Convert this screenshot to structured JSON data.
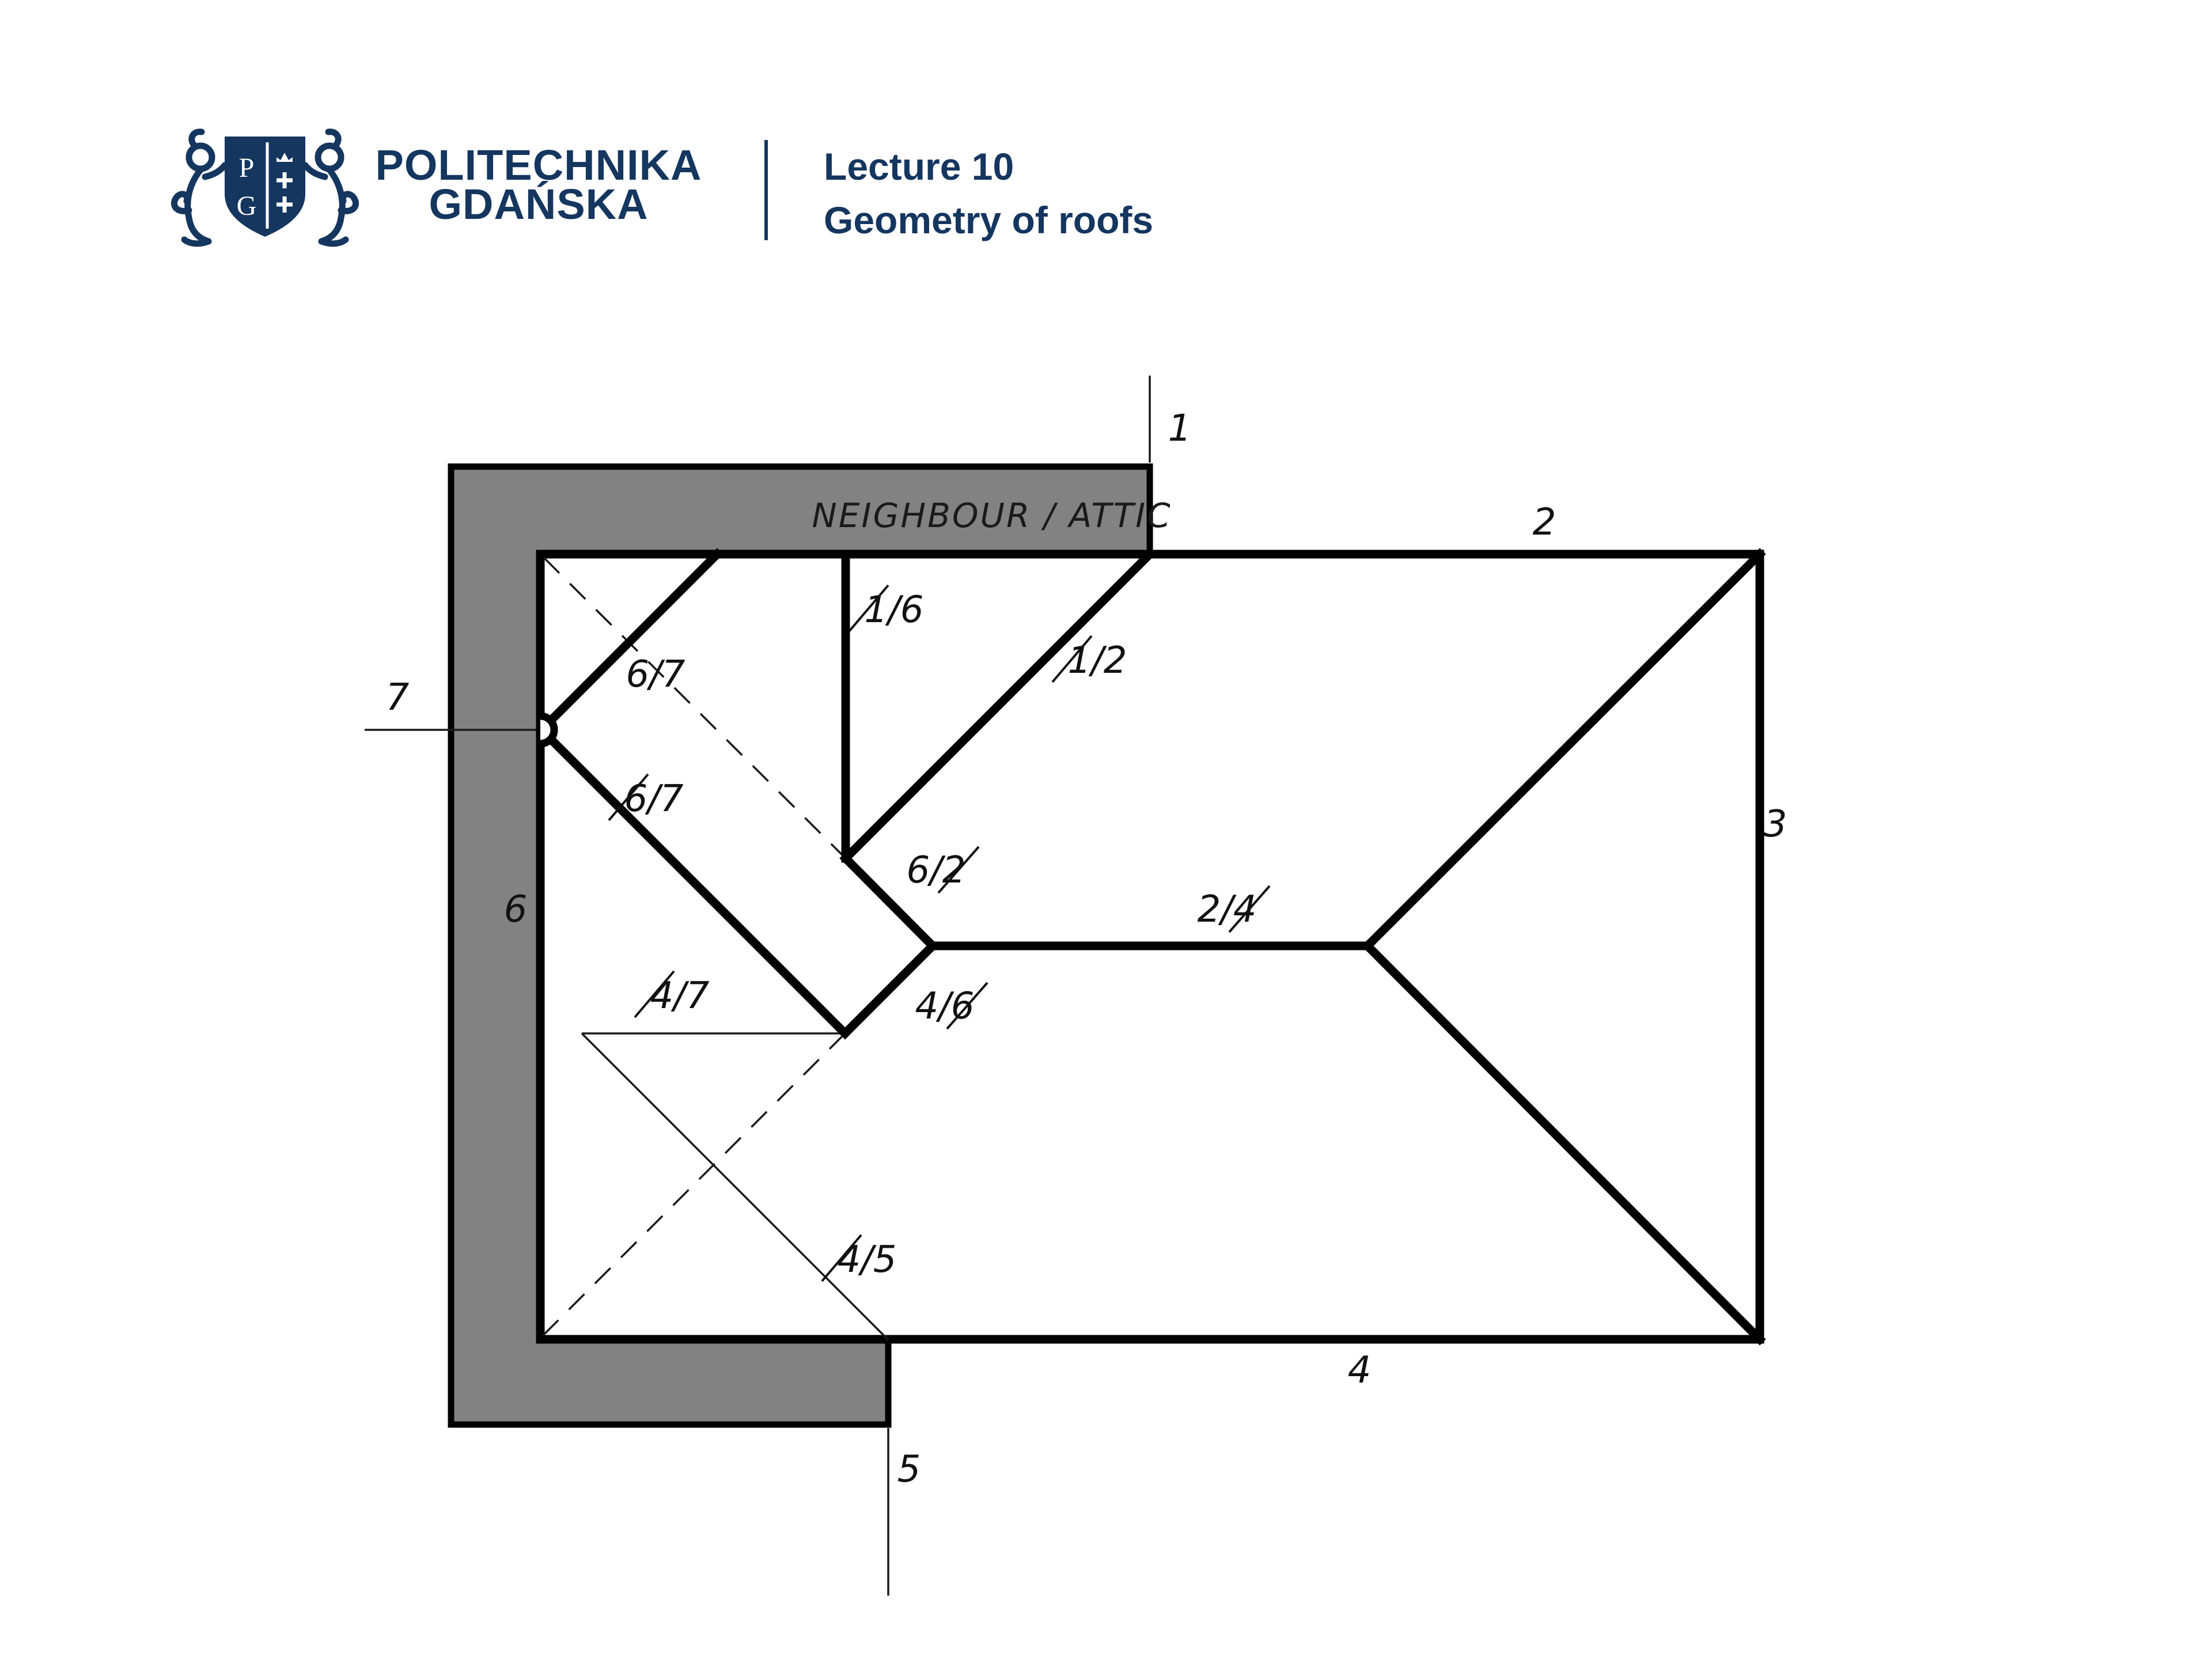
{
  "header": {
    "university_name_line1": "POLITECHNIKA",
    "university_name_line2": "GDAŃSKA",
    "logo_monogram_top": "P",
    "logo_monogram_bottom": "G",
    "lecture_number": "Lecture 10",
    "lecture_title": "Geometry of roofs"
  },
  "diagram": {
    "neighbour_label": "NEIGHBOUR / ATTIC",
    "edge_labels": [
      {
        "text": "1"
      },
      {
        "text": "2"
      },
      {
        "text": "3"
      },
      {
        "text": "4"
      },
      {
        "text": "5"
      },
      {
        "text": "6"
      },
      {
        "text": "7"
      }
    ],
    "plane_labels": [
      {
        "text": "1/6",
        "struck_digit": "1"
      },
      {
        "text": "1/2",
        "struck_digit": "1"
      },
      {
        "text": "6/7",
        "struck_digit": "none"
      },
      {
        "text": "6/7",
        "struck_digit": "6"
      },
      {
        "text": "6/2",
        "struck_digit": "2"
      },
      {
        "text": "2/4",
        "struck_digit": "2"
      },
      {
        "text": "4/6",
        "struck_digit": "6"
      },
      {
        "text": "4/7",
        "struck_digit": "4"
      },
      {
        "text": "4/5",
        "struck_digit": "4"
      }
    ],
    "colors": {
      "neighbour_fill": "#828282",
      "line_color": "#000000",
      "brand_navy": "#14365F"
    }
  }
}
